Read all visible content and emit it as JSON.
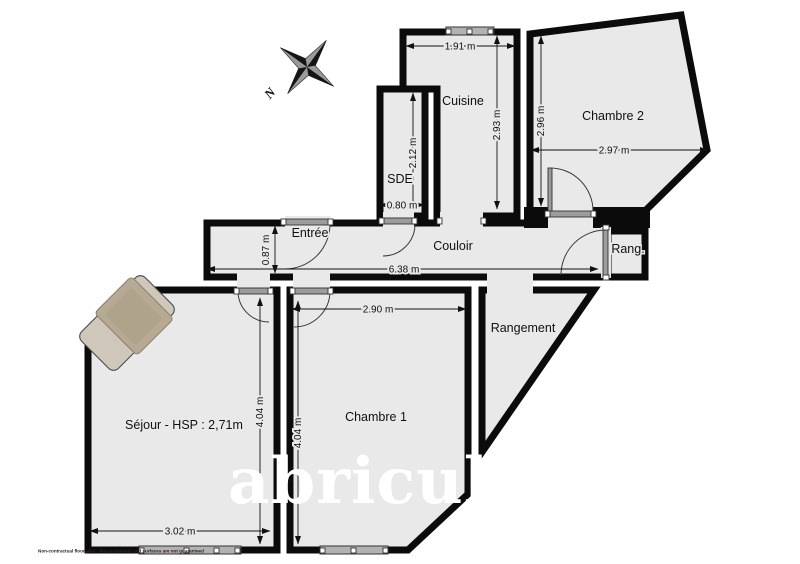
{
  "plan": {
    "rooms": [
      {
        "name": "cuisine",
        "label": "Cuisine"
      },
      {
        "name": "sde",
        "label": "SDE"
      },
      {
        "name": "chambre2",
        "label": "Chambre 2"
      },
      {
        "name": "entree",
        "label": "Entrée"
      },
      {
        "name": "couloir",
        "label": "Couloir"
      },
      {
        "name": "rang",
        "label": "Rang."
      },
      {
        "name": "rangement",
        "label": "Rangement"
      },
      {
        "name": "chambre1",
        "label": "Chambre 1"
      },
      {
        "name": "sejour",
        "label": "Séjour - HSP : 2,71m"
      }
    ],
    "dimensions": [
      {
        "id": "cuisine-width",
        "label": "1.91 m"
      },
      {
        "id": "cuisine-depth",
        "label": "2.93 m"
      },
      {
        "id": "chambre2-depth",
        "label": "2.96 m"
      },
      {
        "id": "chambre2-width",
        "label": "2.97 m"
      },
      {
        "id": "sde-depth",
        "label": "2.12 m"
      },
      {
        "id": "sde-width",
        "label": "0.80 m"
      },
      {
        "id": "entree-depth",
        "label": "0.87 m"
      },
      {
        "id": "couloir-width",
        "label": "6.38 m"
      },
      {
        "id": "chambre1-width",
        "label": "2.90 m"
      },
      {
        "id": "chambre1-depth",
        "label": "4.04 m"
      },
      {
        "id": "sejour-depth",
        "label": "4.04 m"
      },
      {
        "id": "sejour-width",
        "label": "3.02 m"
      }
    ],
    "compass": {
      "north_label": "N"
    },
    "watermark": "abriculteurs",
    "footer": "Non-contractual floor plan - Measurements and surfaces are not guaranteed",
    "colors": {
      "wall": "#0b0b0b",
      "floor": "#e9e9e9",
      "hardware": "#9c9c9c",
      "watermark": "#ffffff"
    }
  }
}
